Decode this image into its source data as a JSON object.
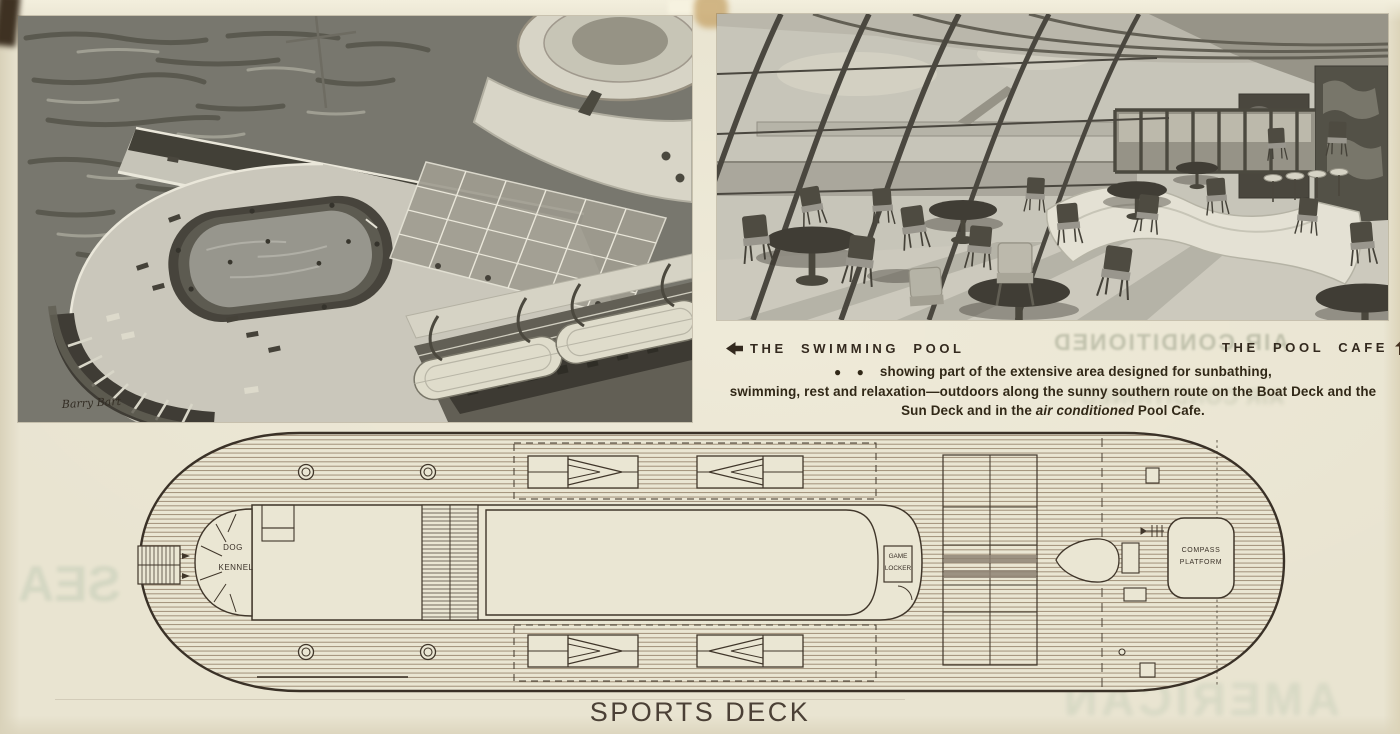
{
  "document": {
    "kind": "ocean liner brochure page",
    "deck_title": "SPORTS DECK"
  },
  "captions": {
    "swimming_pool": "THE SWIMMING POOL",
    "pool_cafe": "THE POOL CAFE",
    "bullets": "● ●",
    "line1": "showing part of the extensive area designed for sunbathing,",
    "line2": "swimming, rest and relaxation—outdoors along the sunny southern route on the Boat Deck and the",
    "line3_pre": "Sun Deck and in the ",
    "line3_italic": "air conditioned",
    "line3_post": " Pool Cafe."
  },
  "photos": {
    "left": {
      "description": "aerial rendering of the stern sun decks with oval swimming pool, glass windscreen, funnel and lifeboats",
      "signature": "Barry Bart"
    },
    "right": {
      "description": "interior rendering of the Pool Cafe with slanted glass wall, pedestal tables, chairs and serpentine banquette"
    }
  },
  "deck_plan": {
    "title": "SPORTS DECK",
    "labels": {
      "dog_kennel": [
        "DOG",
        "KENNEL"
      ],
      "game_locker": [
        "GAME",
        "LOCKER"
      ],
      "compass_platform": [
        "COMPASS",
        "PLATFORM"
      ]
    }
  },
  "ghost_text": {
    "top_right_1": "AIR CONDITIONED",
    "top_right_2": "AIR CONDITIONED",
    "mid_left": "AMERICAN",
    "left_edge": "SEA",
    "bottom_right": "AMERICAN"
  },
  "colors": {
    "paper": "#e9e4d1",
    "ink": "#33291e",
    "plan_line": "#40362a",
    "planking": "#94826b",
    "photo_dark": "#2f2d28",
    "photo_deck": "#c9c7bd",
    "arrow": "#3a2d20"
  }
}
